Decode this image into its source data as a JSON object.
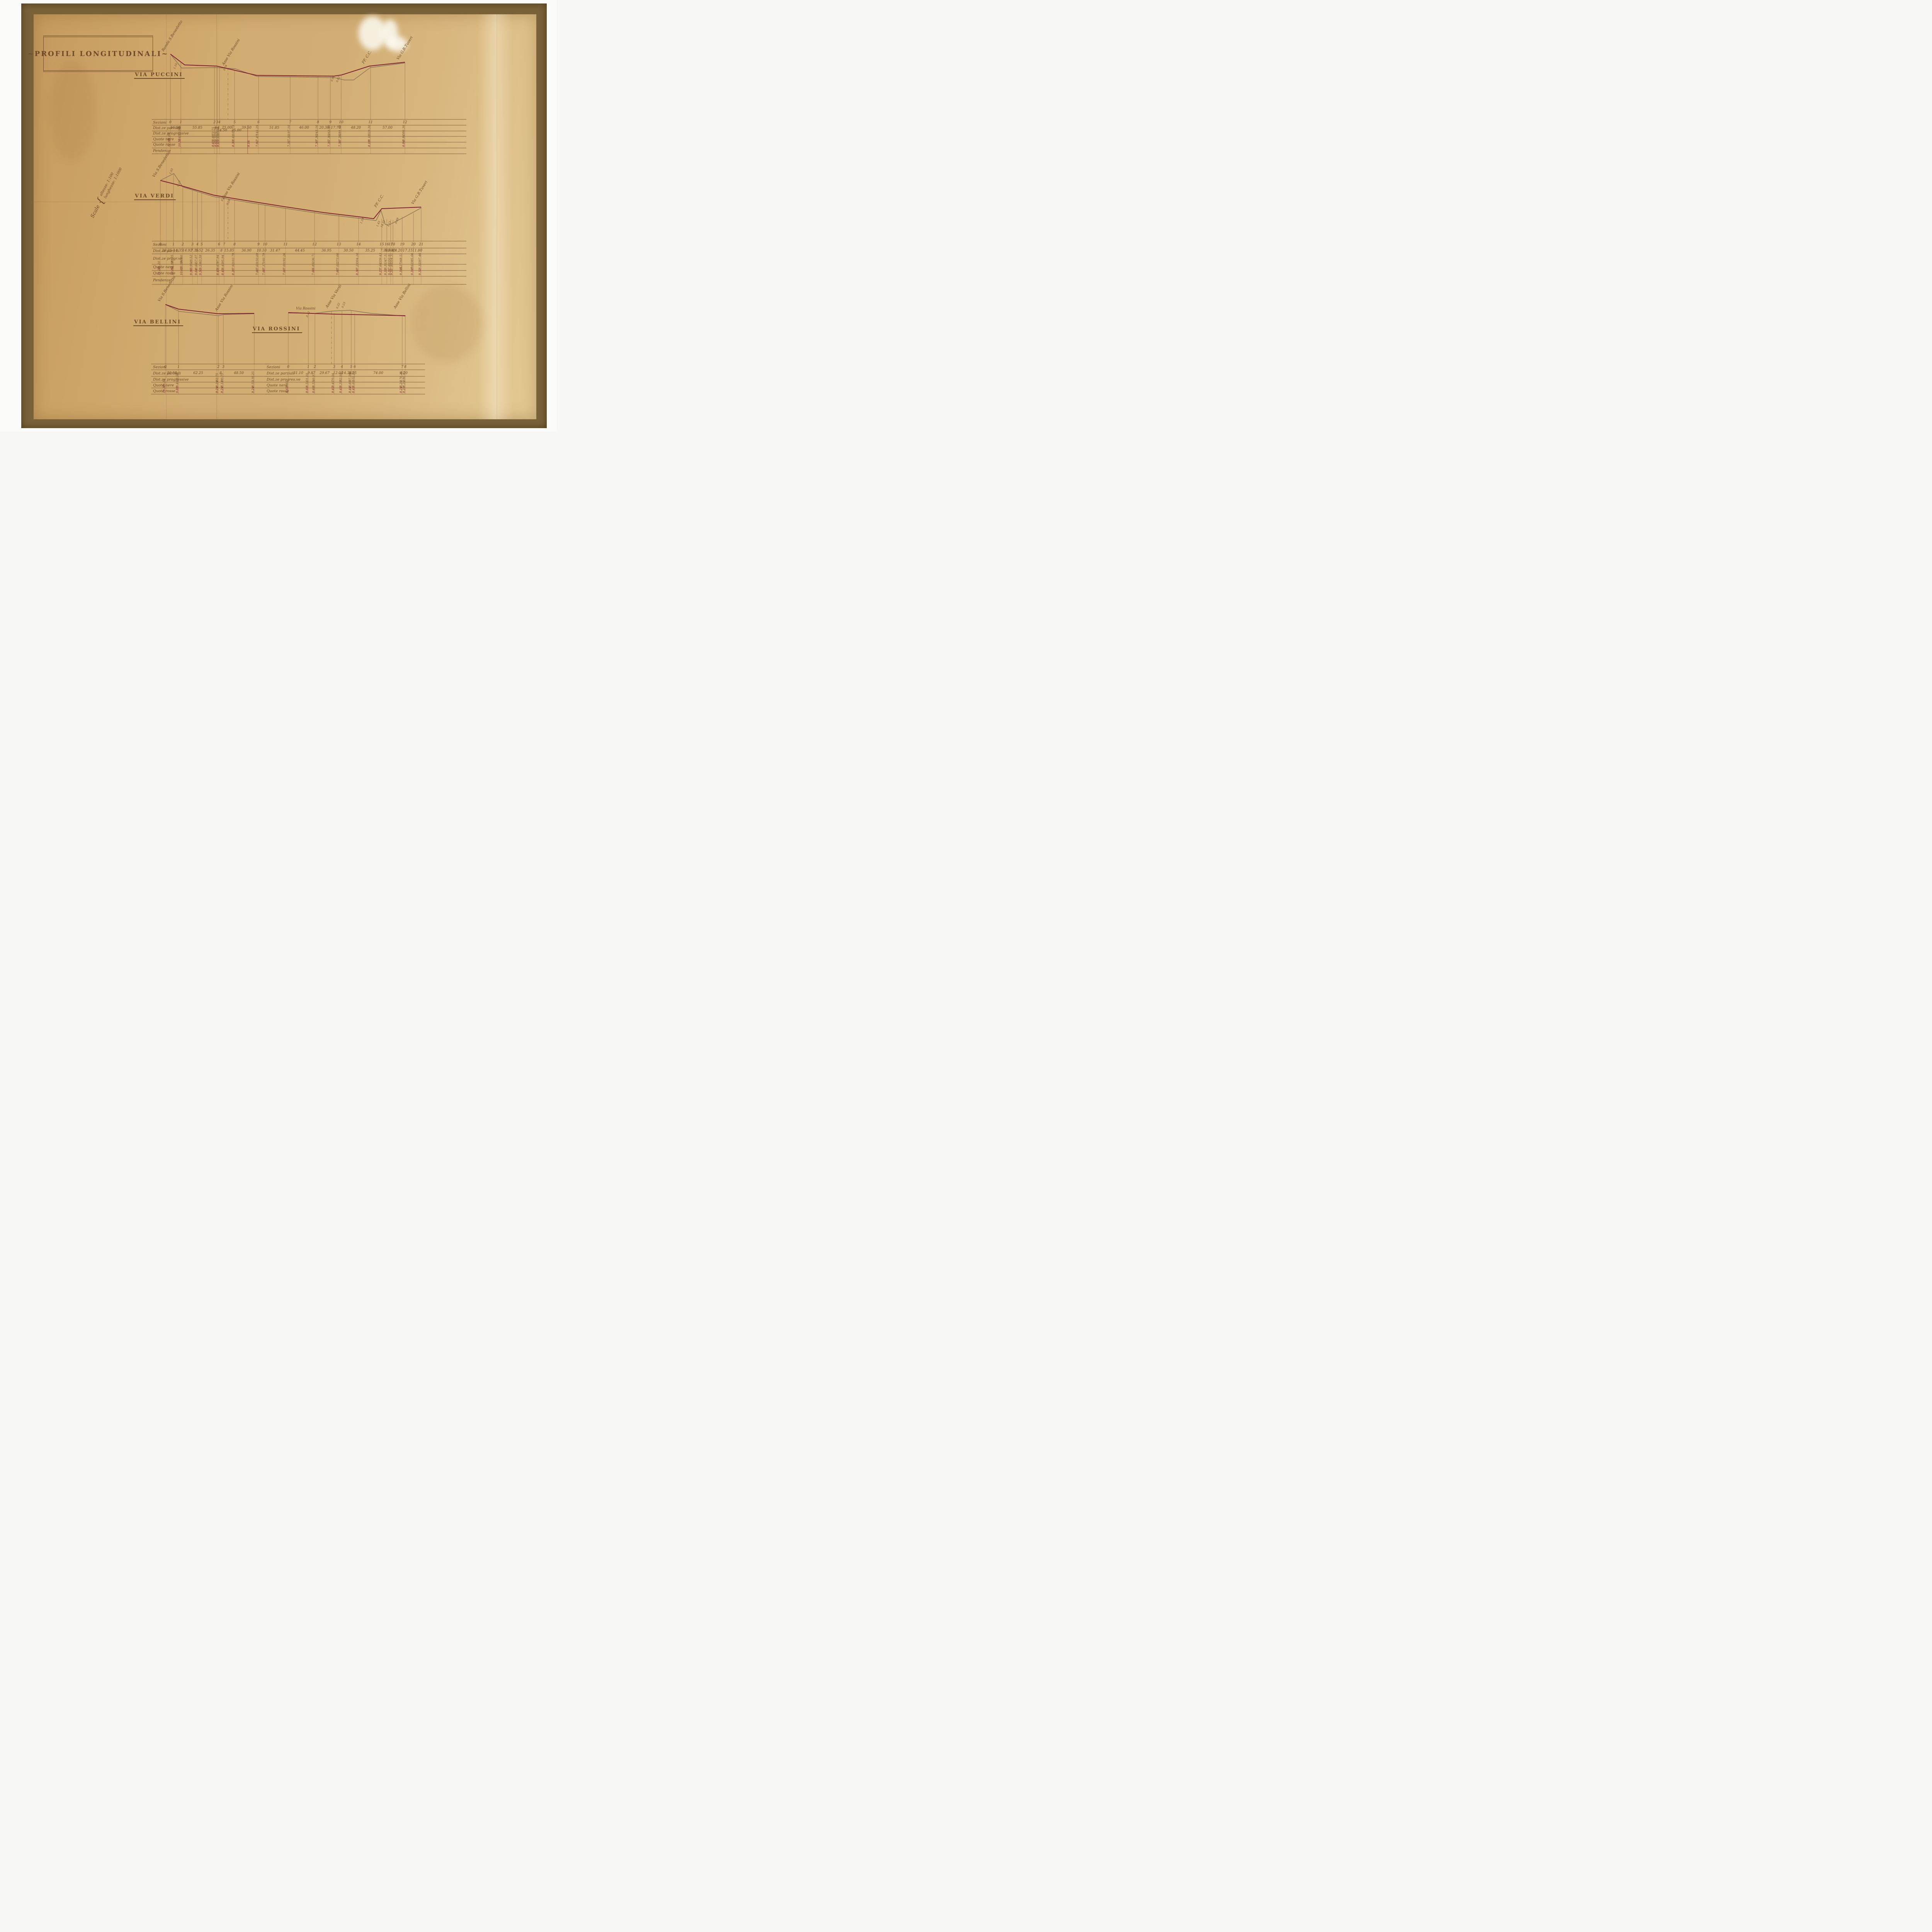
{
  "document": {
    "title": "~PROFILI LONGITUDINALI~",
    "scale_label": "Scale",
    "scale_lines": [
      "altezze: 1:100",
      "lunghezze: 1:1000"
    ]
  },
  "colors": {
    "ink": "#6b4a2a",
    "project_red": "#7d2130",
    "paper": "#d2ac72",
    "frame": "#7a6238"
  },
  "profiles": {
    "puccini": {
      "title": "VIA PUCCINI",
      "endpoints": [
        "Rondò S.Benedetto",
        "Asse Via Rossini",
        "FF. C.C.",
        "Via G.B.Tuveri"
      ],
      "spots": [
        "1.10",
        "0.04",
        "0.90",
        "0.63"
      ],
      "table": {
        "row_labels": [
          "Sezioni",
          "Dist.ze parziali",
          "Dist.ze progressive",
          "Quote nere",
          "Quote rosse",
          "Pendenze"
        ],
        "sezioni": [
          "0",
          "1",
          "2",
          "3",
          "4",
          "5",
          "6",
          "7",
          "8",
          "9",
          "10",
          "11",
          "12"
        ],
        "dist_parziali": [
          "16.90",
          "55.85",
          "4",
          "4",
          "25.00",
          "39.50",
          "51.85",
          "46.00",
          "20.30",
          "17.70",
          "48.20",
          "57.00"
        ],
        "dist_parziali_sub": [
          "14.50",
          "25.00"
        ],
        "dist_progressive": [
          "16.90",
          "72.75",
          "76.75",
          "80.75",
          "105.75",
          "145.25",
          "197.10",
          "243.16",
          "263.40",
          "281.10",
          "329.30",
          "386.30"
        ],
        "quote_nere": [
          "11.08",
          "9.43",
          "8.69",
          "8.55",
          "8.65",
          "8.61",
          "7.47",
          "7.31",
          "7.30",
          "7.30",
          "7.28",
          "8.18",
          "8.84"
        ],
        "quote_rosse": [
          "11.08",
          "10.53",
          "8.65",
          "8.65",
          "8.65",
          "8.30",
          "7.92",
          "7.31",
          "7.30",
          "7.35",
          "7.38",
          "8.18",
          "8.84"
        ],
        "quote_rosse_extra": "8.16"
      }
    },
    "verdi": {
      "title": "VIA VERDI",
      "endpoints": [
        "Via S.Benedetto",
        "Asse Via Rossini",
        "FF. C.C.",
        "Via G.B.Tuveri"
      ],
      "spots": [
        "1.03",
        "0.17",
        "0.22",
        "0.28",
        "1.59",
        "1.43",
        "14.31",
        "1.11",
        "0.69"
      ],
      "table": {
        "row_labels": [
          "Sezioni",
          "Dist.ze parz.li",
          "Dist.ze progr.ve",
          "Quote nere",
          "Quote rosse",
          "Pendenze"
        ],
        "sezioni": [
          "0",
          "1",
          "2",
          "3",
          "4",
          "5",
          "6",
          "7",
          "8",
          "9",
          "10",
          "11",
          "12",
          "13",
          "14",
          "15",
          "16",
          "17",
          "18",
          "19",
          "20",
          "21"
        ],
        "dist_parziali": [
          "20.25",
          "14.35",
          "14.92",
          "7.55",
          "6.52",
          "26.35",
          "8",
          "15.85",
          "36.90",
          "10.10",
          "31.47",
          "44.45",
          "36.95",
          "30.50",
          "35.25",
          "7.90",
          "5.60",
          "3.40",
          "14.20",
          "17.15",
          "11.80"
        ],
        "dist_progressive": [
          "20.25",
          "34.60",
          "49.52",
          "57.07",
          "63.59",
          "87.94",
          "95.94",
          "103.79",
          "150.69",
          "160.79",
          "192.26",
          "236.71",
          "273.66",
          "304.16",
          "339.43",
          "347.31",
          "350.91",
          "354.31",
          "368.51",
          "385.66",
          "397.46"
        ],
        "quote_nere": [
          "11.20",
          "11.88",
          "10.80",
          "9.96",
          "9.64",
          "9.50",
          "8.67",
          "8.45",
          "7.92",
          "7.60",
          "7.17",
          "7.01",
          "6.89",
          "7.02",
          "7.29",
          "7.64",
          "9.31",
          "7.88",
          "7.88",
          "8.27",
          "8.62",
          "9.32"
        ],
        "quote_rosse": [
          "11.20",
          "10.85",
          "10.63",
          "9.96",
          "9.64",
          "9.50",
          "8.45",
          "8.45",
          "8.20",
          "7.60",
          "7.60",
          "7.60",
          "7.60",
          "7.60",
          "8.30",
          "9.23",
          "9.31",
          "9.31",
          "9.31",
          "9.315",
          "9.317",
          "9.32"
        ]
      }
    },
    "bellini": {
      "title": "VIA BELLINI",
      "endpoints": [
        "Via S.Benedetto",
        "Asse Via Rossini"
      ],
      "spots": [],
      "table": {
        "row_labels": [
          "Sezioni",
          "Dist.ze parziali",
          "Dist.ze progressive",
          "Quote nere",
          "Quote rosse"
        ],
        "sezioni": [
          "0",
          "1",
          "2",
          "3"
        ],
        "dist_parziali": [
          "20.50",
          "62.25",
          "8",
          "48.50"
        ],
        "dist_progressive": [
          "20.50",
          "82.75",
          "90.75",
          "139.25"
        ],
        "quote_nere": [
          "10.30",
          "9.40",
          "8.24",
          "8.14",
          "8.55"
        ],
        "quote_rosse": [
          "10.30",
          "9.88",
          "8.24",
          "8.24",
          "8.24"
        ]
      }
    },
    "rossini": {
      "title": "VIA ROSSINI",
      "header_label": "Via Rossini",
      "endpoints": [
        "Asse Via Verdi",
        "Asse Via Bellini"
      ],
      "spots": [
        "0.12",
        "0.22",
        "0.23"
      ],
      "table": {
        "row_labels": [
          "Sezioni",
          "Dist.ze parziali",
          "Dist.ze progres.ve",
          "Quote nere",
          "Quote rosse"
        ],
        "sezioni": [
          "0",
          "1",
          "2",
          "3",
          "4",
          "5",
          "6",
          "7",
          "8"
        ],
        "dist_parziali": [
          "31.10",
          "9.87",
          "29.67",
          "12.00",
          "14.36",
          "5.25",
          "74.00",
          "4.20"
        ],
        "dist_progressive": [
          "31.10",
          "40.97",
          "70.64",
          "82.64",
          "97.00",
          "102.25",
          "176.25",
          "180.45"
        ],
        "quote_nere": [
          "8.65",
          "8.51",
          "8.55",
          "8.45",
          "8.33",
          "8.66",
          "8.66",
          "8.24",
          "8.24"
        ],
        "quote_rosse": [
          "8.65",
          "8.60",
          "8.66",
          "8.45",
          "8.45",
          "8.44",
          "8.43",
          "8.24",
          "8.23"
        ]
      }
    }
  },
  "chart_data": [
    {
      "type": "line",
      "title": "Via Puccini - profilo longitudinale",
      "xlabel": "distanza progressiva (m)",
      "ylabel": "quota (m)",
      "x": [
        0,
        16.9,
        72.75,
        76.75,
        80.75,
        105.75,
        145.25,
        197.1,
        243.16,
        263.4,
        281.1,
        329.3,
        386.3
      ],
      "series": [
        {
          "name": "terreno (quote nere)",
          "values": [
            11.08,
            9.43,
            8.69,
            8.55,
            8.65,
            8.61,
            7.47,
            7.31,
            7.3,
            7.3,
            7.28,
            8.18,
            8.84
          ]
        },
        {
          "name": "progetto (quote rosse)",
          "values": [
            11.08,
            10.53,
            8.65,
            8.65,
            8.65,
            8.3,
            7.92,
            7.31,
            7.3,
            7.35,
            7.38,
            8.18,
            8.84
          ]
        }
      ]
    },
    {
      "type": "line",
      "title": "Via Verdi - profilo longitudinale",
      "xlabel": "distanza progressiva (m)",
      "ylabel": "quota (m)",
      "x": [
        0,
        20.25,
        34.6,
        49.52,
        57.07,
        63.59,
        87.94,
        95.94,
        103.79,
        150.69,
        160.79,
        192.26,
        236.71,
        273.66,
        304.16,
        339.43,
        347.31,
        350.91,
        354.31,
        368.51,
        385.66,
        397.46
      ],
      "series": [
        {
          "name": "terreno (quote nere)",
          "values": [
            11.2,
            11.88,
            10.8,
            9.96,
            9.64,
            9.5,
            8.67,
            8.45,
            7.92,
            7.6,
            7.17,
            7.01,
            6.89,
            7.02,
            7.29,
            7.64,
            9.31,
            7.88,
            7.88,
            8.27,
            8.62,
            9.32
          ]
        },
        {
          "name": "progetto (quote rosse)",
          "values": [
            11.2,
            10.85,
            10.63,
            9.96,
            9.64,
            9.5,
            8.45,
            8.45,
            8.2,
            7.6,
            7.6,
            7.6,
            7.6,
            7.6,
            8.3,
            9.23,
            9.31,
            9.31,
            9.31,
            9.315,
            9.317,
            9.32
          ]
        }
      ]
    },
    {
      "type": "line",
      "title": "Via Bellini - profilo longitudinale",
      "xlabel": "distanza progressiva (m)",
      "ylabel": "quota (m)",
      "x": [
        0,
        20.5,
        82.75,
        90.75,
        139.25
      ],
      "series": [
        {
          "name": "terreno (quote nere)",
          "values": [
            10.3,
            9.4,
            8.24,
            8.14,
            8.55
          ]
        },
        {
          "name": "progetto (quote rosse)",
          "values": [
            10.3,
            9.88,
            8.24,
            8.24,
            8.24
          ]
        }
      ]
    },
    {
      "type": "line",
      "title": "Via Rossini - profilo longitudinale",
      "xlabel": "distanza progressiva (m)",
      "ylabel": "quota (m)",
      "x": [
        0,
        31.1,
        40.97,
        70.64,
        82.64,
        97.0,
        102.25,
        176.25,
        180.45
      ],
      "series": [
        {
          "name": "terreno (quote nere)",
          "values": [
            8.65,
            8.51,
            8.55,
            8.45,
            8.33,
            8.66,
            8.66,
            8.24,
            8.24
          ]
        },
        {
          "name": "progetto (quote rosse)",
          "values": [
            8.65,
            8.6,
            8.66,
            8.45,
            8.45,
            8.44,
            8.43,
            8.24,
            8.23
          ]
        }
      ]
    }
  ]
}
